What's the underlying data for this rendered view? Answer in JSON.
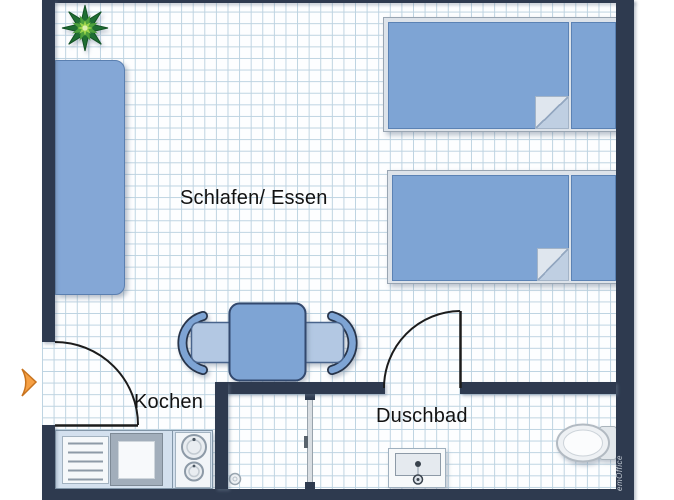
{
  "rooms": {
    "main": {
      "label": "Schlafen/ Essen"
    },
    "kitchen": {
      "label": "Kochen"
    },
    "bath": {
      "label": "Duschbad"
    }
  },
  "watermark": {
    "text": "emOffice"
  },
  "furniture_icons": [
    "plant-icon",
    "sofa",
    "single-bed",
    "single-bed",
    "dining-table",
    "chair",
    "chair",
    "kitchenette",
    "shower-glass-door",
    "shower-drain",
    "washbasin",
    "toilet",
    "entry-arrow-icon"
  ],
  "colors": {
    "wall": "#2e3a4f",
    "furniture_blue": "#7ea4d4",
    "furniture_blue_light": "#b3c8e3",
    "bed_frame": "#dde3ea",
    "grid_line": "#bdd3e1",
    "floor": "#ffffff",
    "door_swing": "#1c1c1c",
    "entry_arrow": "#f6a044",
    "plant_dark": "#1f6e33",
    "plant_mid": "#4ea13c",
    "plant_light": "#9ed54b",
    "fixture_white": "#f5f8fa"
  }
}
